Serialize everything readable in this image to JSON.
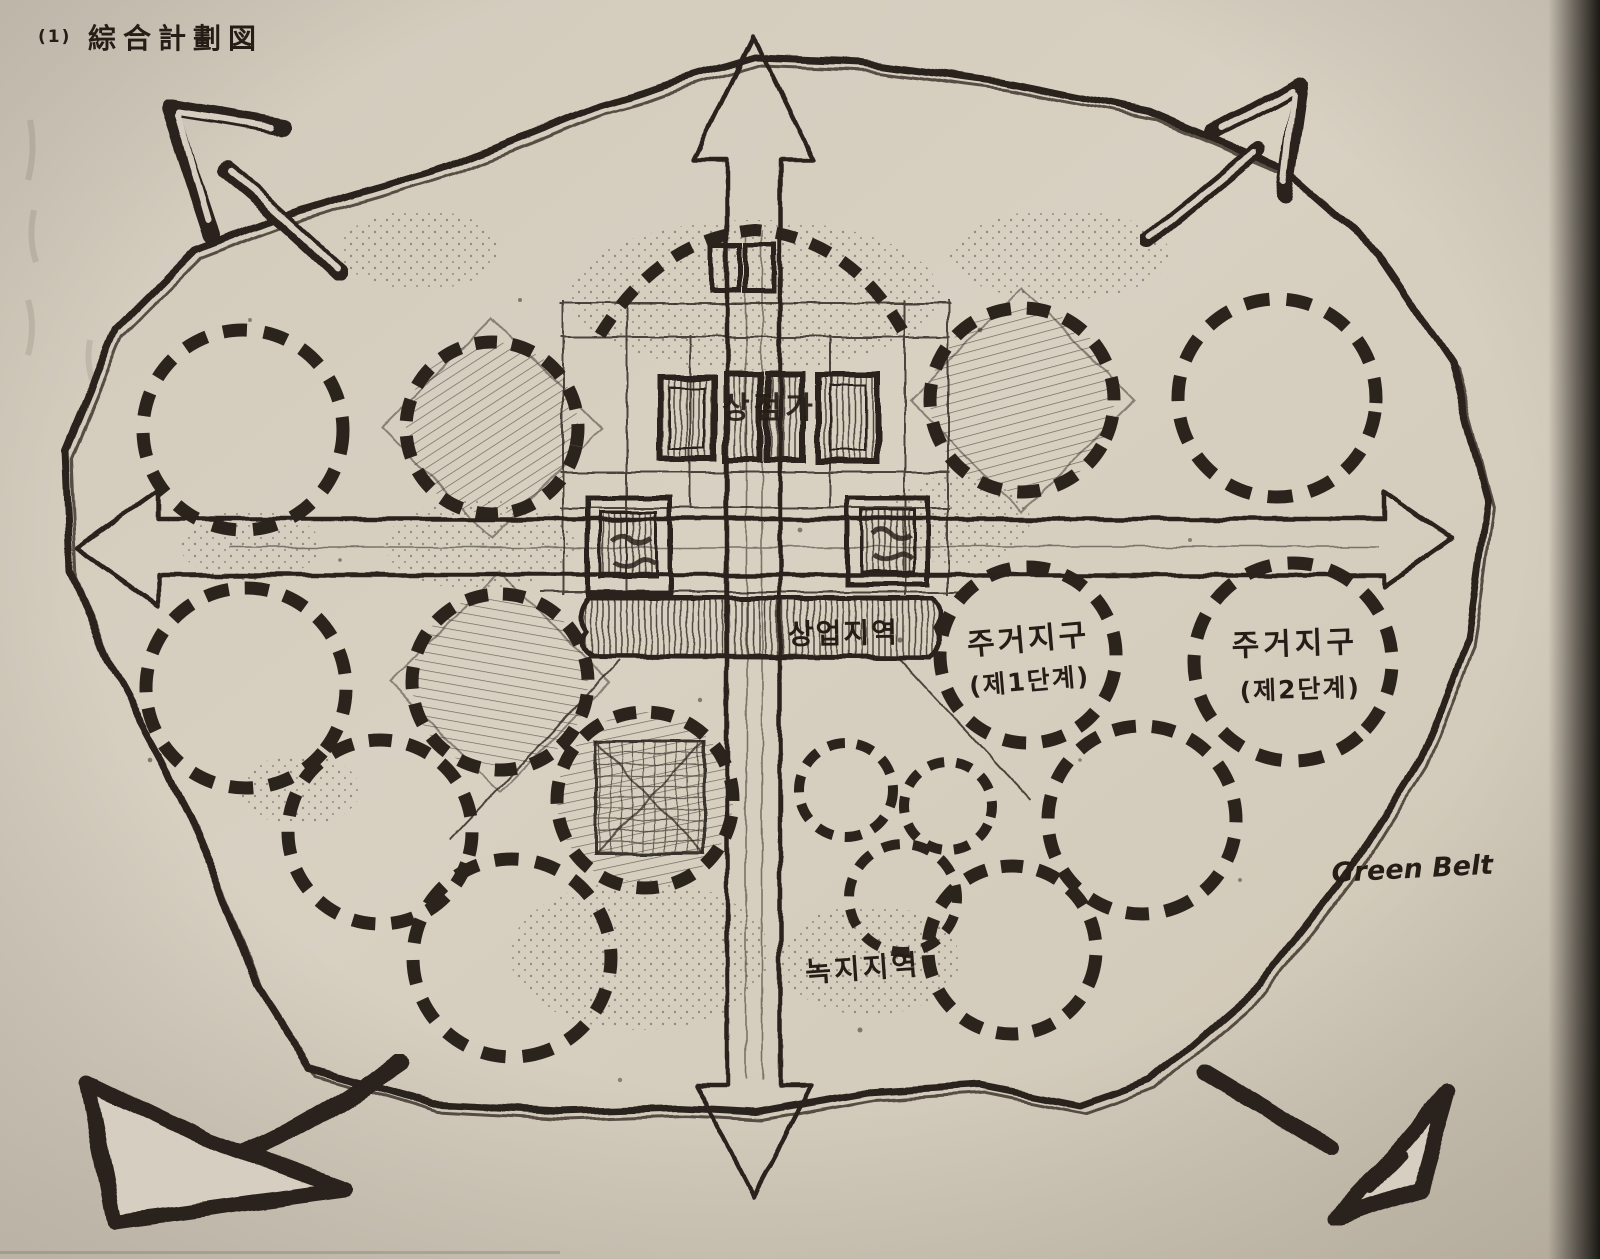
{
  "page": {
    "scan_index": "(1)",
    "title": "綜合計劃図"
  },
  "labels": {
    "commercial_zone": "상업지역",
    "civic_center_stamp": "상점가",
    "residential_phase1_line1": "주거지구",
    "residential_phase1_line2": "(제1단계)",
    "residential_phase2_line1": "주거지구",
    "residential_phase2_line2": "(제2단계)",
    "green_zone": "녹지지역",
    "green_belt": "Green Belt"
  },
  "colors": {
    "paper": "#d6cec0",
    "ink": "#2b241d"
  }
}
